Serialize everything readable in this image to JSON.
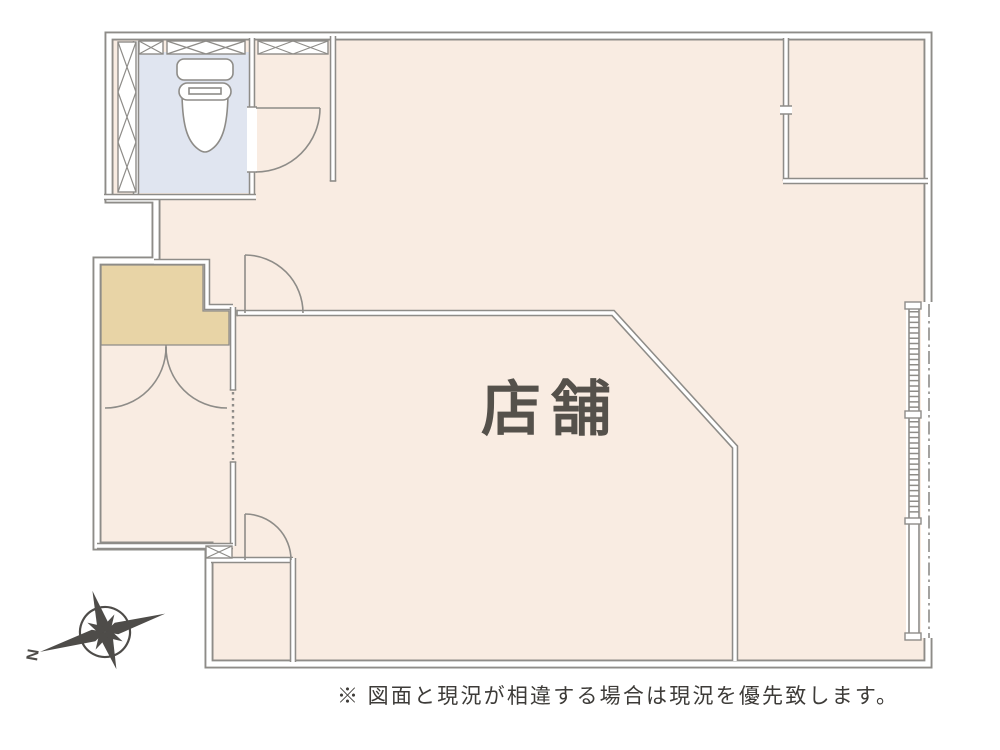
{
  "plan": {
    "shop_label": "店舗",
    "disclaimer": "※ 図面と現況が相違する場合は現況を優先致します。",
    "compass_north_label": "N"
  },
  "colors": {
    "floor": "#f9ece2",
    "closet": "#e8d4a6",
    "toilet-room": "#e0e5f0",
    "wall": "#8e8c88",
    "label-text": "#55514b",
    "disclaimer-text": "#3d3b38",
    "compass": "#4e4c49"
  }
}
